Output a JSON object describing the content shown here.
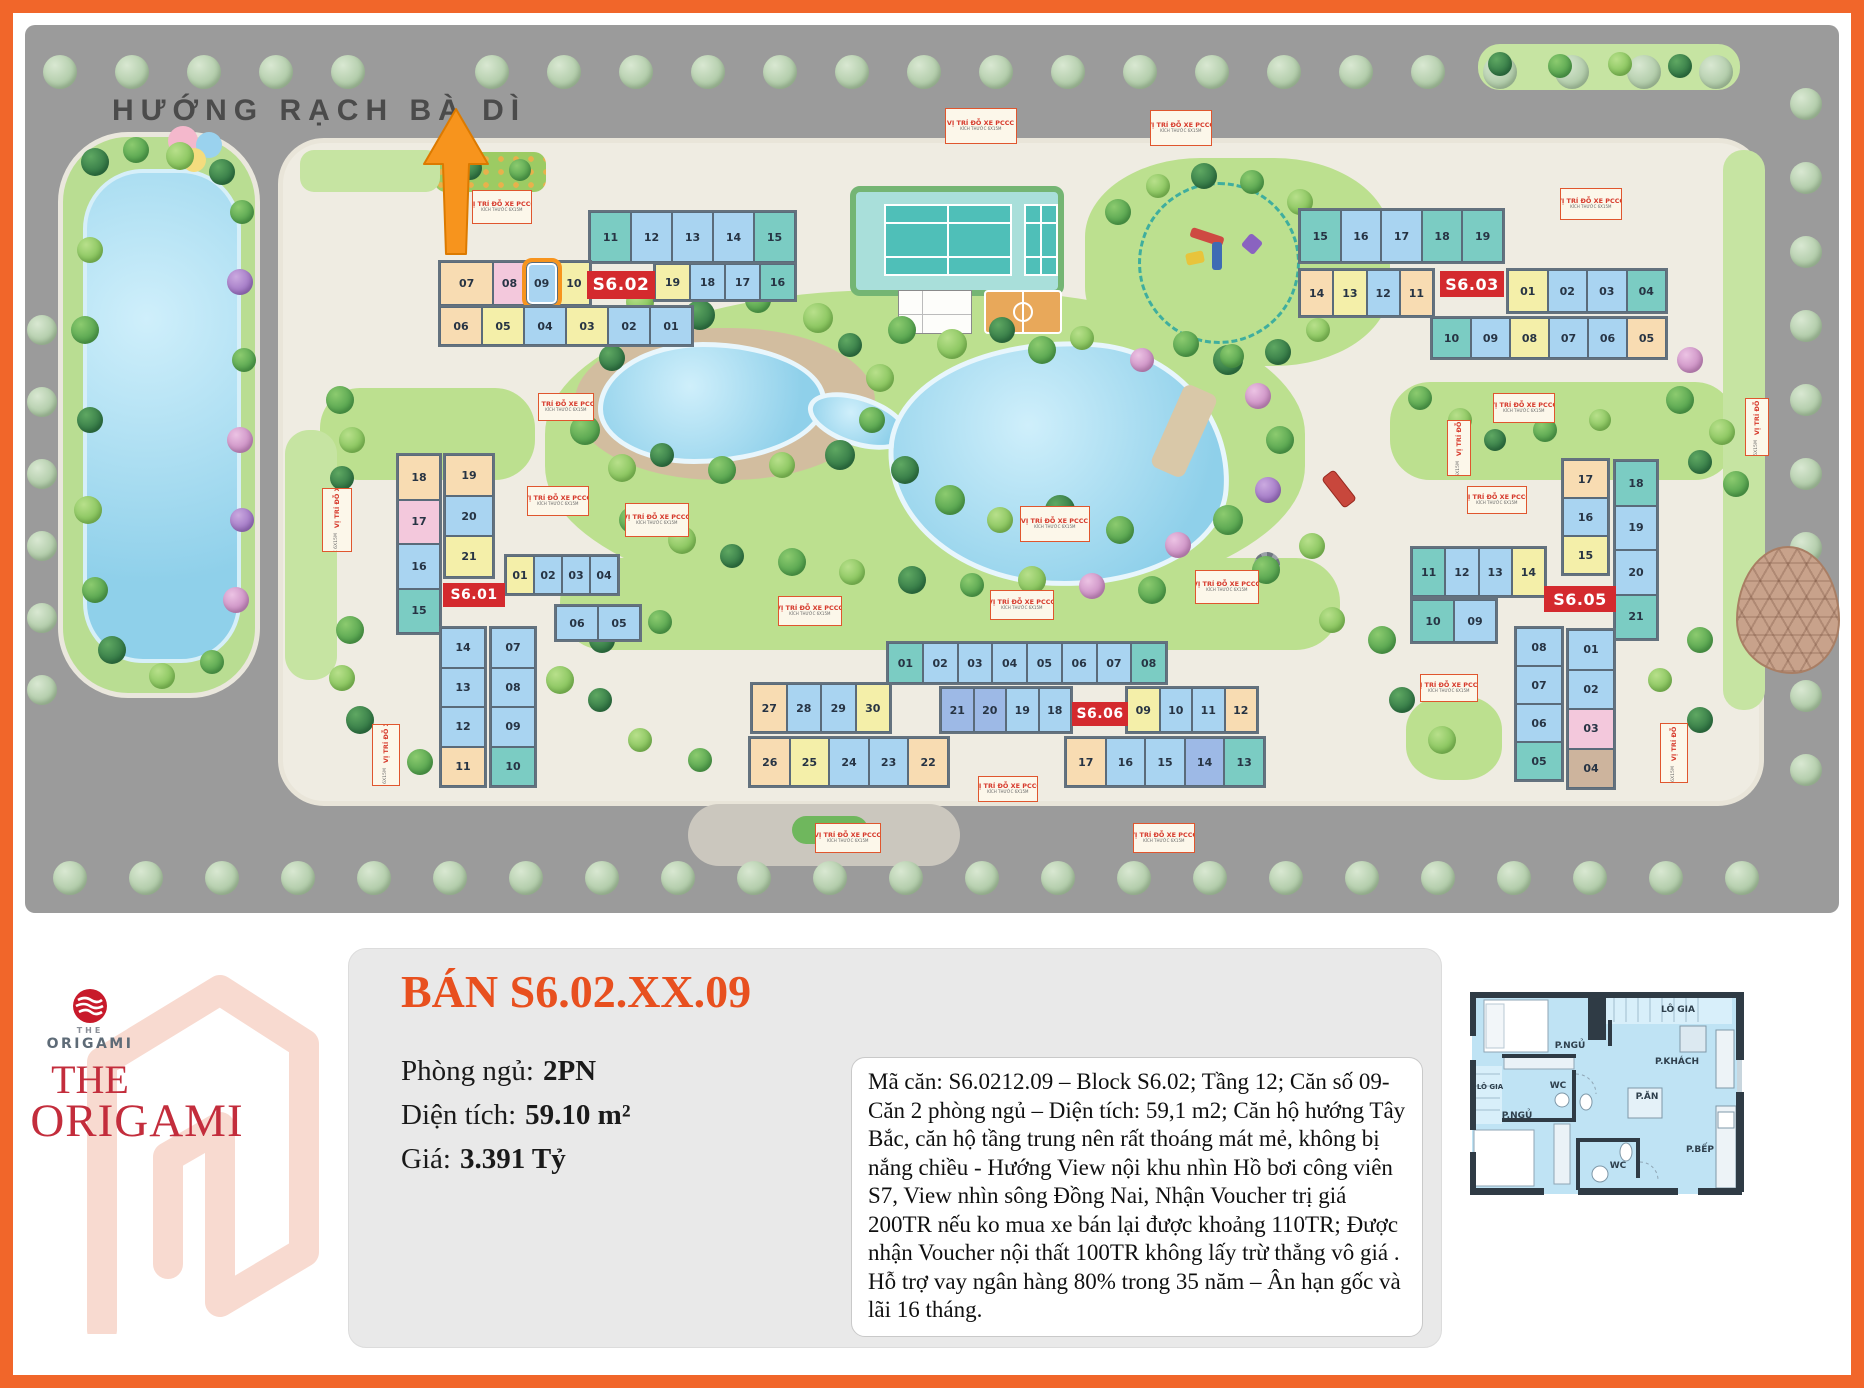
{
  "colors": {
    "frame": "#F1662A",
    "badge_red": "#D42A2E",
    "highlight_orange": "#F7941D",
    "title_orange": "#E8501F",
    "brand_red": "#C32D3C"
  },
  "map": {
    "heading": "HƯỚNG RẠCH BÀ DÌ",
    "parking_title": "VỊ TRÍ ĐỖ XE PCCC",
    "parking_sub": "KÍCH THƯỚC 6X15M",
    "highlight_unit": "09",
    "blocks": [
      {
        "label": "S6.01"
      },
      {
        "label": "S6.02"
      },
      {
        "label": "S6.03"
      },
      {
        "label": "S6.05"
      },
      {
        "label": "S6.06"
      }
    ],
    "strips": {
      "s602_a": [
        {
          "n": "11",
          "c": "t"
        },
        {
          "n": "12",
          "c": "b"
        },
        {
          "n": "13",
          "c": "b"
        },
        {
          "n": "14",
          "c": "b"
        },
        {
          "n": "15",
          "c": "t"
        }
      ],
      "s602_b": [
        {
          "n": "19",
          "c": "y"
        },
        {
          "n": "18",
          "c": "b"
        },
        {
          "n": "17",
          "c": "b"
        },
        {
          "n": "16",
          "c": "t"
        }
      ],
      "s602_c": [
        {
          "n": "07",
          "c": "p"
        },
        {
          "n": "08",
          "c": "pk"
        },
        {
          "n": "09",
          "c": "b",
          "hl": true
        },
        {
          "n": "10",
          "c": "y"
        }
      ],
      "s602_d": [
        {
          "n": "06",
          "c": "p"
        },
        {
          "n": "05",
          "c": "y"
        },
        {
          "n": "04",
          "c": "b"
        },
        {
          "n": "03",
          "c": "y"
        },
        {
          "n": "02",
          "c": "b"
        },
        {
          "n": "01",
          "c": "b"
        }
      ],
      "s603_a": [
        {
          "n": "15",
          "c": "t"
        },
        {
          "n": "16",
          "c": "b"
        },
        {
          "n": "17",
          "c": "b"
        },
        {
          "n": "18",
          "c": "t"
        },
        {
          "n": "19",
          "c": "t"
        }
      ],
      "s603_b": [
        {
          "n": "14",
          "c": "p"
        },
        {
          "n": "13",
          "c": "y"
        },
        {
          "n": "12",
          "c": "b"
        },
        {
          "n": "11",
          "c": "p"
        }
      ],
      "s603_c": [
        {
          "n": "01",
          "c": "y"
        },
        {
          "n": "02",
          "c": "b"
        },
        {
          "n": "03",
          "c": "b"
        },
        {
          "n": "04",
          "c": "t"
        }
      ],
      "s603_d": [
        {
          "n": "10",
          "c": "t"
        },
        {
          "n": "09",
          "c": "b"
        },
        {
          "n": "08",
          "c": "y"
        },
        {
          "n": "07",
          "c": "b"
        },
        {
          "n": "06",
          "c": "b"
        },
        {
          "n": "05",
          "c": "p"
        }
      ],
      "s601_l": [
        {
          "n": "18",
          "c": "p"
        },
        {
          "n": "17",
          "c": "pk"
        },
        {
          "n": "16",
          "c": "b"
        },
        {
          "n": "15",
          "c": "t"
        }
      ],
      "s601_m": [
        {
          "n": "19",
          "c": "p"
        },
        {
          "n": "20",
          "c": "b"
        },
        {
          "n": "21",
          "c": "y"
        }
      ],
      "s601_r1": [
        {
          "n": "01",
          "c": "y"
        },
        {
          "n": "02",
          "c": "b"
        },
        {
          "n": "03",
          "c": "b"
        },
        {
          "n": "04",
          "c": "b"
        }
      ],
      "s601_r2": [
        {
          "n": "06",
          "c": "b"
        },
        {
          "n": "05",
          "c": "b"
        }
      ],
      "s601_c1": [
        {
          "n": "14",
          "c": "b"
        },
        {
          "n": "13",
          "c": "b"
        },
        {
          "n": "12",
          "c": "b"
        },
        {
          "n": "11",
          "c": "p"
        }
      ],
      "s601_c2": [
        {
          "n": "07",
          "c": "b"
        },
        {
          "n": "08",
          "c": "b"
        },
        {
          "n": "09",
          "c": "b"
        },
        {
          "n": "10",
          "c": "t"
        }
      ],
      "s605_t": [
        {
          "n": "11",
          "c": "t"
        },
        {
          "n": "12",
          "c": "b"
        },
        {
          "n": "13",
          "c": "b"
        },
        {
          "n": "14",
          "c": "y"
        }
      ],
      "s605_b": [
        {
          "n": "10",
          "c": "t"
        },
        {
          "n": "09",
          "c": "b"
        }
      ],
      "s605_m": [
        {
          "n": "17",
          "c": "p"
        },
        {
          "n": "16",
          "c": "b"
        },
        {
          "n": "15",
          "c": "y"
        }
      ],
      "s605_r": [
        {
          "n": "18",
          "c": "t"
        },
        {
          "n": "19",
          "c": "b"
        },
        {
          "n": "20",
          "c": "b"
        },
        {
          "n": "21",
          "c": "t"
        }
      ],
      "s605_bl": [
        {
          "n": "08",
          "c": "b"
        },
        {
          "n": "07",
          "c": "b"
        },
        {
          "n": "06",
          "c": "b"
        },
        {
          "n": "05",
          "c": "t"
        }
      ],
      "s605_br": [
        {
          "n": "01",
          "c": "b"
        },
        {
          "n": "02",
          "c": "b"
        },
        {
          "n": "03",
          "c": "pk"
        },
        {
          "n": "04",
          "c": "tn"
        }
      ],
      "s606_t": [
        {
          "n": "01",
          "c": "t"
        },
        {
          "n": "02",
          "c": "b"
        },
        {
          "n": "03",
          "c": "b"
        },
        {
          "n": "04",
          "c": "b"
        },
        {
          "n": "05",
          "c": "b"
        },
        {
          "n": "06",
          "c": "b"
        },
        {
          "n": "07",
          "c": "b"
        },
        {
          "n": "08",
          "c": "t"
        }
      ],
      "s606_ml": [
        {
          "n": "27",
          "c": "p"
        },
        {
          "n": "28",
          "c": "b"
        },
        {
          "n": "29",
          "c": "b"
        },
        {
          "n": "30",
          "c": "y"
        }
      ],
      "s606_mc": [
        {
          "n": "21",
          "c": "b2"
        },
        {
          "n": "20",
          "c": "b2"
        },
        {
          "n": "19",
          "c": "b"
        },
        {
          "n": "18",
          "c": "b"
        }
      ],
      "s606_mr": [
        {
          "n": "09",
          "c": "y"
        },
        {
          "n": "10",
          "c": "b"
        },
        {
          "n": "11",
          "c": "b"
        },
        {
          "n": "12",
          "c": "p"
        }
      ],
      "s606_bl": [
        {
          "n": "26",
          "c": "p"
        },
        {
          "n": "25",
          "c": "y"
        },
        {
          "n": "24",
          "c": "b"
        },
        {
          "n": "23",
          "c": "b"
        },
        {
          "n": "22",
          "c": "p"
        }
      ],
      "s606_br": [
        {
          "n": "17",
          "c": "p"
        },
        {
          "n": "16",
          "c": "b"
        },
        {
          "n": "15",
          "c": "b"
        },
        {
          "n": "14",
          "c": "b2"
        },
        {
          "n": "13",
          "c": "t"
        }
      ]
    }
  },
  "logo": {
    "small_the": "THE",
    "small_name": "ORIGAMI",
    "big_the": "THE",
    "big_name": "ORIGAMI"
  },
  "listing": {
    "title": "BÁN S6.02.XX.09",
    "fields": [
      {
        "label": "Phòng ngủ:",
        "value": "2PN"
      },
      {
        "label": "Diện tích:",
        "value": "59.10 m²"
      },
      {
        "label": "Giá:",
        "value": "3.391 Tỷ"
      }
    ],
    "description": "Mã căn: S6.0212.09 – Block S6.02; Tầng 12; Căn số 09- Căn 2 phòng ngủ – Diện tích: 59,1 m2; Căn hộ hướng Tây Bắc, căn hộ tầng trung nên rất thoáng mát mẻ, không bị nắng chiều - Hướng View nội khu nhìn Hồ bơi công viên S7, View nhìn sông Đồng Nai, Nhận Voucher trị giá 200TR nếu ko mua xe bán lại được khoảng 110TR; Được nhận Voucher nội thất 100TR không lấy trừ thẳng vô giá . Hỗ trợ vay ngân hàng 80% trong 35 năm – Ân hạn gốc và lãi 16 tháng."
  },
  "floorplan": {
    "labels": [
      "LÔ GIA",
      "P.NGỦ",
      "P.KHÁCH",
      "LÔ GIA",
      "WC",
      "P.ĂN",
      "P.NGỦ",
      "WC",
      "P.BẾP"
    ]
  }
}
